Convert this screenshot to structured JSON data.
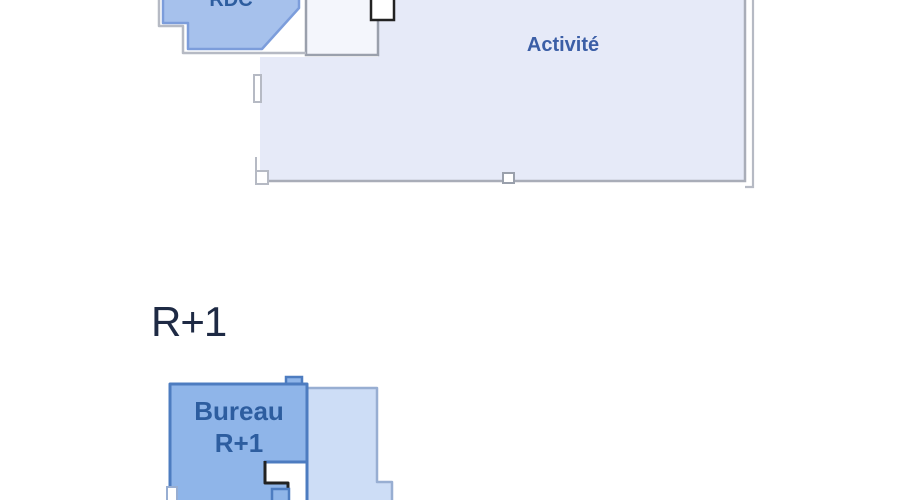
{
  "colors": {
    "background": "#ffffff",
    "bureau_rdc_fill": "#a6c1ec",
    "bureau_rdc_border": "#7c9ddb",
    "bureau_r1_fill": "#8fb5e9",
    "bureau_r1_border": "#4d7cc0",
    "annex_fill": "#cdddf6",
    "annex_border": "#98aed2",
    "activity_fill": "#e6eaf8",
    "activity_border": "#a9adb8",
    "white_room_fill": "#f4f6fc",
    "white_room_border": "#9aa0ac",
    "outer_wall": "#b6bac4",
    "dark_outline": "#222222",
    "room_label_blue": "#2d5d9f",
    "activity_label_blue": "#3b5ea6",
    "heading_navy": "#1e2a44"
  },
  "floor_rdc": {
    "bureau_room_label": "RDC",
    "activity_room_label": "Activité"
  },
  "floor_r1": {
    "heading": "R+1",
    "bureau_room_label_line1": "Bureau",
    "bureau_room_label_line2": "R+1"
  }
}
